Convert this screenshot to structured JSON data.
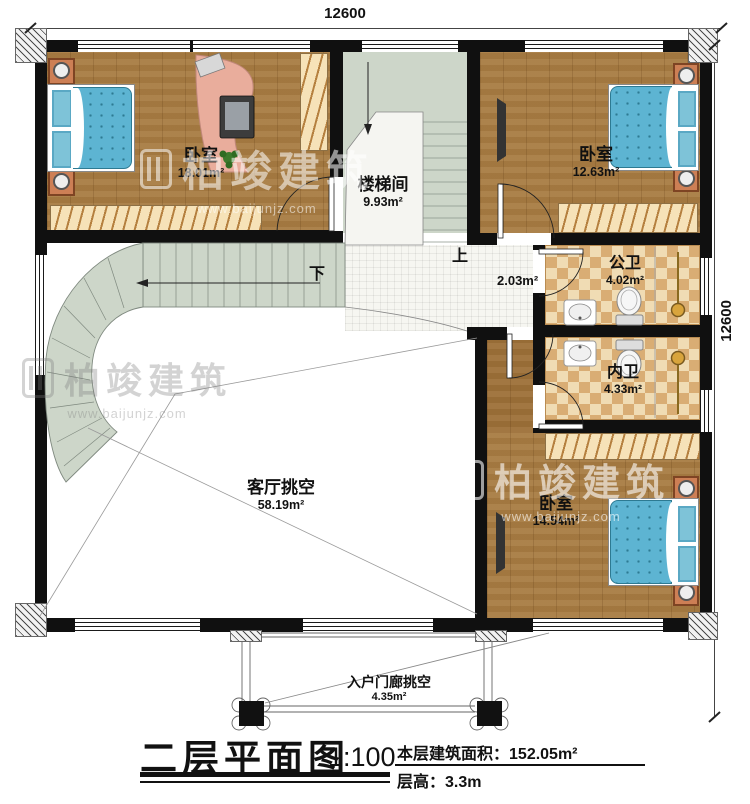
{
  "dimensions": {
    "top": "12600",
    "right": "12600"
  },
  "rooms": [
    {
      "id": "bedroom-top-left",
      "name": "卧室",
      "area": "18.01m²"
    },
    {
      "id": "stairwell",
      "name": "楼梯间",
      "area": "9.93m²"
    },
    {
      "id": "bedroom-top-right",
      "name": "卧室",
      "area": "12.63m²"
    },
    {
      "id": "public-bathroom",
      "name": "公卫",
      "area": "4.02m²"
    },
    {
      "id": "private-bathroom",
      "name": "内卫",
      "area": "4.33m²"
    },
    {
      "id": "bedroom-bottom",
      "name": "卧室",
      "area": "14.54m²"
    },
    {
      "id": "living-room-void",
      "name": "客厅挑空",
      "area": "58.19m²"
    },
    {
      "id": "corridor",
      "name": "",
      "area": "2.03m²"
    },
    {
      "id": "entry-porch-void",
      "name": "入户门廊挑空",
      "area": "4.35m²"
    }
  ],
  "stairs": {
    "up": "上",
    "down": "下"
  },
  "title": {
    "name": "二层平面图",
    "scale": "1:100",
    "area_label": "本层建筑面积：",
    "area_value": "152.05m²",
    "height_label": "层高：",
    "height_value": "3.3m"
  },
  "watermark": {
    "brand": "柏竣建筑",
    "url": "www.baijunjz.com"
  },
  "colors": {
    "wall": "#101010",
    "wood_floor": "#a87c42",
    "stair_floor": "#cdd6c9",
    "bath_tile": "#d9ad74",
    "bed_blue": "#5db4d2",
    "furniture_orange": "#cd7f55",
    "desk_salmon": "#e9ad9c"
  }
}
